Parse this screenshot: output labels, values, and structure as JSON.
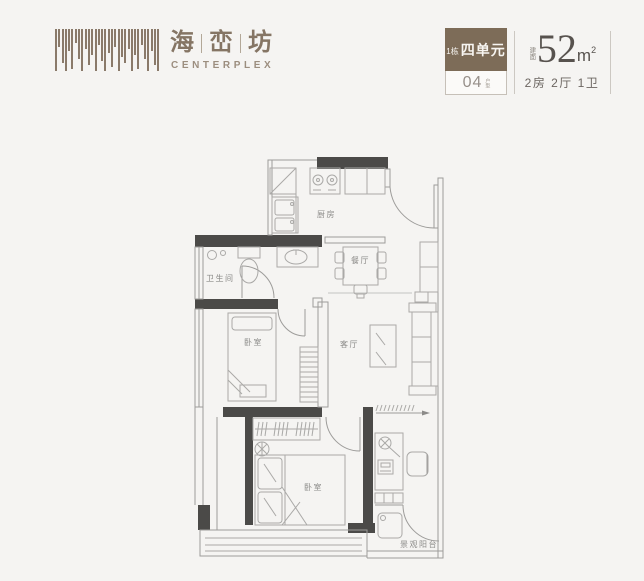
{
  "brand": {
    "chars": [
      "海",
      "峦",
      "坊"
    ],
    "english": "CENTERPLEX"
  },
  "unit": {
    "building": "1栋",
    "unit_name": "四单元",
    "plan_no": "04",
    "plan_no_label": "户型",
    "area_prefix": "建面",
    "area_number": "52",
    "area_unit": "m",
    "area_sup": "2",
    "rooms_summary": "2房 2厅 1卫"
  },
  "plan": {
    "labels": {
      "kitchen": "厨房",
      "dining": "餐厅",
      "bathroom": "卫生间",
      "bedroom1": "卧室",
      "living": "客厅",
      "bedroom2": "卧室",
      "balcony": "景观阳台"
    }
  },
  "colors": {
    "background": "#f5f4f2",
    "brand_brown": "#8a7a6a",
    "badge_brown": "#7d6c58",
    "wall_dark": "#4b4a48",
    "line_gray": "#9d9c9a"
  }
}
